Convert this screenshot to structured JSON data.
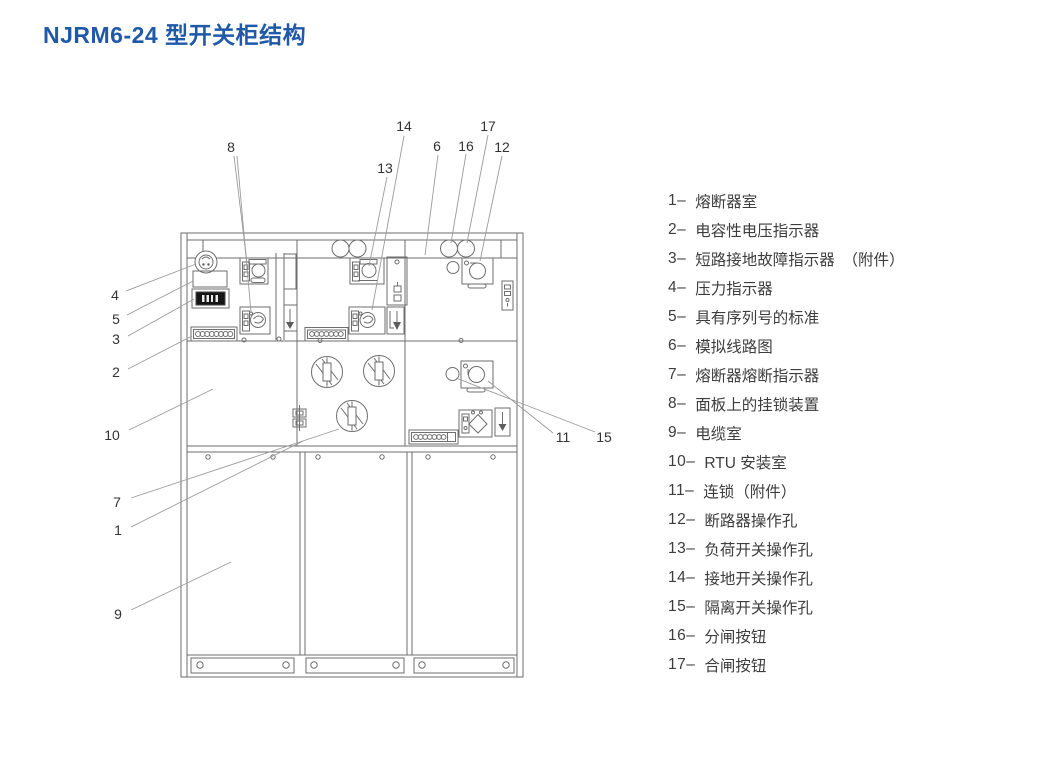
{
  "title": "NJRM6-24 型开关柜结构",
  "colors": {
    "title_blue": "#2059a8",
    "diagram_line": "#6e6e6e",
    "legend_text": "#3d3d3d"
  },
  "callouts": [
    {
      "label": "1"
    },
    {
      "label": "2"
    },
    {
      "label": "3"
    },
    {
      "label": "4"
    },
    {
      "label": "5"
    },
    {
      "label": "6"
    },
    {
      "label": "7"
    },
    {
      "label": "8"
    },
    {
      "label": "9"
    },
    {
      "label": "10"
    },
    {
      "label": "11"
    },
    {
      "label": "12"
    },
    {
      "label": "13"
    },
    {
      "label": "14"
    },
    {
      "label": "15"
    },
    {
      "label": "16"
    },
    {
      "label": "17"
    }
  ],
  "legend": {
    "items": [
      {
        "label": "1–",
        "text": "熔断器室"
      },
      {
        "label": "2–",
        "text": "电容性电压指示器"
      },
      {
        "label": "3–",
        "text": "短路接地故障指示器　（附件）"
      },
      {
        "label": "4–",
        "text": "压力指示器"
      },
      {
        "label": "5–",
        "text": "具有序列号的标准"
      },
      {
        "label": "6–",
        "text": "模拟线路图"
      },
      {
        "label": "7–",
        "text": "熔断器熔断指示器"
      },
      {
        "label": "8–",
        "text": "面板上的挂锁装置"
      },
      {
        "label": "9–",
        "text": "电缆室"
      },
      {
        "label": "10–",
        "text": "RTU 安装室"
      },
      {
        "label": "11–",
        "text": "连锁（附件）"
      },
      {
        "label": "12–",
        "text": "断路器操作孔"
      },
      {
        "label": "13–",
        "text": "负荷开关操作孔"
      },
      {
        "label": "14–",
        "text": "接地开关操作孔"
      },
      {
        "label": "15–",
        "text": "隔离开关操作孔"
      },
      {
        "label": "16–",
        "text": "分闸按钮"
      },
      {
        "label": "17–",
        "text": "合闸按钮"
      }
    ]
  }
}
